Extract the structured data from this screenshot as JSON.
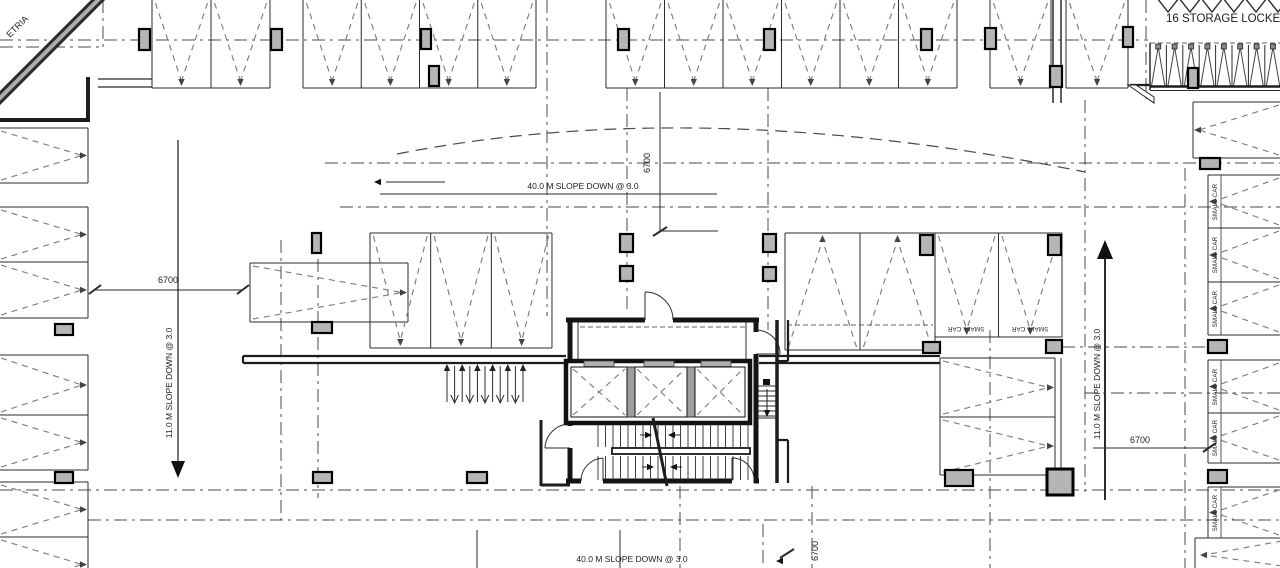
{
  "drawing": {
    "title_storage": "16 STORAGE LOCKERS",
    "slope_40_top": "40.0 M SLOPE DOWN  @ 3.0",
    "slope_40_bottom": "40.0 M SLOPE DOWN  @ 3.0",
    "slope_11_left": "11.0 M SLOPE DOWN  @ 3.0",
    "slope_11_right": "11.0 M SLOPE DOWN  @ 3.0",
    "dim_left": "6700",
    "dim_center": "6700",
    "dim_right": "6700",
    "dim_bottom": "6700",
    "small_car": "SMALL CAR",
    "corner_text": "ETRIA",
    "colors": {
      "background": "#ffffff",
      "line": "#2a2a2a",
      "stall_dash": "#7d7d7d",
      "wall": "#141414",
      "column_fill": "#b5b5b5",
      "locker_fill": "#8a8a8a"
    }
  }
}
